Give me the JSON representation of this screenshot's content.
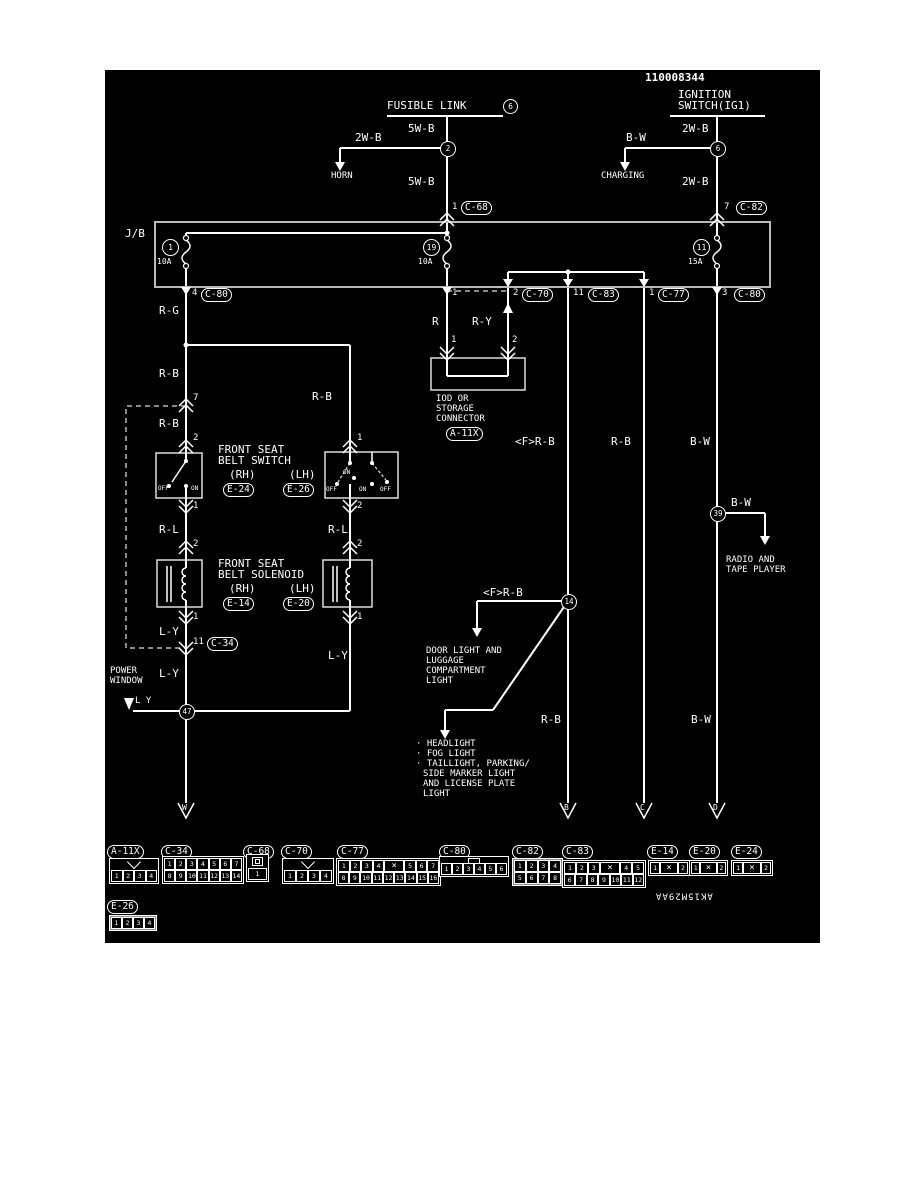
{
  "doc_number": "110008344",
  "drawing_code": "AK15M29AA",
  "top": {
    "fl_label": "FUSIBLE LINK",
    "fl_num": "6",
    "ign1": "IGNITION",
    "ign2": "SWITCH(IG1)",
    "w5b_1": "5W-B",
    "w2b_horn": "2W-B",
    "horn": "HORN",
    "w5b_2": "5W-B",
    "j2": "2",
    "w2b_1": "2W-B",
    "bw_chg": "B-W",
    "charging": "CHARGING",
    "w2b_2": "2W-B",
    "j6": "6",
    "pin1": "1",
    "c68": "C-68",
    "pin7": "7",
    "c82": "C-82"
  },
  "jb": {
    "label": "J/B",
    "f1_num": "1",
    "f1_amp": "10A",
    "f19_num": "19",
    "f19_amp": "10A",
    "f11_num": "11",
    "f11_amp": "15A",
    "x4": "4",
    "x4c": "C-80",
    "x1": "1",
    "x2": "2",
    "x2c": "C-70",
    "x11": "11",
    "x11c": "C-83",
    "x1b": "1",
    "x1bc": "C-77",
    "x3": "3",
    "x3c": "C-80"
  },
  "belt": {
    "rg": "R-G",
    "rb1": "R-B",
    "p7": "7",
    "rb2": "R-B",
    "p2": "2",
    "rb_branch": "R-B",
    "p1": "1",
    "t1": "FRONT SEAT",
    "t2": "BELT SWITCH",
    "rh": "(RH)",
    "lh": "(LH)",
    "e24": "E-24",
    "e26": "E-26",
    "off": "OFF",
    "on": "ON",
    "rh_out": "1",
    "lh_out": "2",
    "rl": "R-L",
    "rl2": "R-L",
    "s_in": "2",
    "s_in2": "2",
    "st1": "FRONT SEAT",
    "st2": "BELT SOLENOID",
    "srh": "(RH)",
    "slh": "(LH)",
    "e14": "E-14",
    "e20": "E-20",
    "s_out": "1",
    "s_out2": "1",
    "ly1": "L-Y",
    "p11": "11",
    "c34": "C-34",
    "ly2": "L-Y",
    "ly3": "L Y",
    "ly4": "L-Y",
    "pw1": "POWER",
    "pw2": "WINDOW",
    "j47": "47",
    "aw": "W"
  },
  "iod": {
    "p1": "1",
    "p2": "2",
    "r": "R",
    "ry": "R-Y",
    "p1b": "1",
    "p2b": "2",
    "t1": "IOD OR",
    "t2": "STORAGE",
    "t3": "CONNECTOR",
    "ref": "A-11X"
  },
  "cols": {
    "frb": "<F>R-B",
    "rb": "R-B",
    "bw": "B-W",
    "j39": "39",
    "bw2": "B-W",
    "rad1": "RADIO AND",
    "rad2": "TAPE PLAYER",
    "j14": "14",
    "frb2": "<F>R-B",
    "d1": "DOOR LIGHT AND",
    "d2": "LUGGAGE",
    "d3": "COMPARTMENT",
    "d4": "LIGHT",
    "l1": "· HEADLIGHT",
    "l2": "· FOG LIGHT",
    "l3": "· TAILLIGHT, PARKING/",
    "l4": "SIDE MARKER LIGHT",
    "l5": "AND LICENSE PLATE",
    "l6": "LIGHT",
    "rb_bot": "R-B",
    "bw_bot": "B-W",
    "ab": "B",
    "ac": "C",
    "ad": "D"
  },
  "pinouts": [
    {
      "ref": "A-11X",
      "type": "notch",
      "rows": [
        [
          "1",
          "2",
          "3",
          "4"
        ]
      ]
    },
    {
      "ref": "C-34",
      "type": "",
      "rows": [
        [
          "1",
          "2",
          "3",
          "4",
          "5",
          "6",
          "7"
        ],
        [
          "8",
          "9",
          "10",
          "11",
          "12",
          "13",
          "14"
        ]
      ]
    },
    {
      "ref": "C-68",
      "type": "single",
      "rows": [
        [
          "1"
        ]
      ]
    },
    {
      "ref": "C-70",
      "type": "notch",
      "rows": [
        [
          "1",
          "2",
          "3",
          "4"
        ]
      ]
    },
    {
      "ref": "C-77",
      "type": "",
      "rows": [
        [
          "1",
          "2",
          "3",
          "4",
          "X",
          "5",
          "6",
          "7"
        ],
        [
          "8",
          "9",
          "10",
          "11",
          "12",
          "13",
          "14",
          "15",
          "16"
        ]
      ]
    },
    {
      "ref": "C-80",
      "type": "tab",
      "rows": [
        [
          "1",
          "2",
          "3",
          "4",
          "5",
          "6"
        ]
      ]
    },
    {
      "ref": "C-82",
      "type": "shaded",
      "rows": [
        [
          "1",
          "2",
          "3",
          "4"
        ],
        [
          "5",
          "6",
          "7",
          "8"
        ]
      ]
    },
    {
      "ref": "C-83",
      "type": "",
      "rows": [
        [
          "1",
          "2",
          "3",
          "X",
          "4",
          "5"
        ],
        [
          "6",
          "7",
          "8",
          "9",
          "10",
          "11",
          "12"
        ]
      ]
    },
    {
      "ref": "E-14",
      "type": "",
      "rows": [
        [
          "1",
          "X",
          "2"
        ]
      ]
    },
    {
      "ref": "E-20",
      "type": "",
      "rows": [
        [
          "1",
          "X",
          "2"
        ]
      ]
    },
    {
      "ref": "E-24",
      "type": "",
      "rows": [
        [
          "1",
          "X",
          "2"
        ]
      ]
    },
    {
      "ref": "E-26",
      "type": "shaded",
      "rows": [
        [
          "1",
          "2",
          "3",
          "4"
        ]
      ]
    }
  ]
}
